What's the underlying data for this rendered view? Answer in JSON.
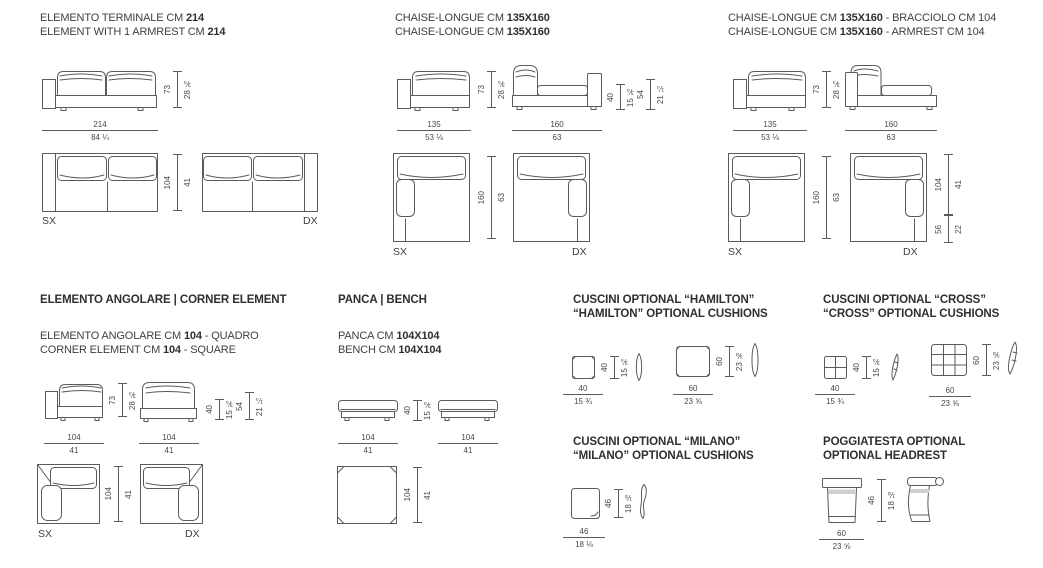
{
  "colors": {
    "line": "#5a5b5f",
    "text": "#3f4044",
    "heading": "#2e2f33",
    "background": "#ffffff"
  },
  "labels": {
    "sx": "SX",
    "dx": "DX"
  },
  "terminal": {
    "title1": {
      "pre": "ELEMENTO TERMINALE CM ",
      "bold": "214",
      "post": ""
    },
    "title2": {
      "pre": "ELEMENT WITH 1 ARMREST CM ",
      "bold": "214",
      "post": ""
    },
    "height": {
      "cm": "73",
      "in": "28 ¾"
    },
    "width": {
      "cm": "214",
      "in": "84 ¼"
    },
    "depth": {
      "cm": "104",
      "in": "41"
    }
  },
  "chaise": {
    "title1": {
      "pre": "CHAISE-LONGUE CM ",
      "bold": "135X160",
      "post": ""
    },
    "title2": {
      "pre": "CHAISE-LONGUE CM ",
      "bold": "135X160",
      "post": ""
    },
    "w135": {
      "cm": "135",
      "in": "53 ⅛"
    },
    "w160": {
      "cm": "160",
      "in": "63"
    },
    "height": {
      "cm": "73",
      "in": "28 ¾"
    },
    "seat_h": {
      "cm": "40",
      "in": "15 ¾"
    },
    "arm_h": {
      "cm": "54",
      "in": "21 ¼"
    },
    "depth": {
      "cm": "160",
      "in": "63"
    }
  },
  "chaiseArm": {
    "title1": {
      "pre": "CHAISE-LONGUE CM ",
      "bold": "135X160",
      "post": " - BRACCIOLO CM 104"
    },
    "title2": {
      "pre": "CHAISE-LONGUE CM ",
      "bold": "135X160",
      "post": " - ARMREST CM 104"
    },
    "w135": {
      "cm": "135",
      "in": "53 ⅛"
    },
    "w160": {
      "cm": "160",
      "in": "63"
    },
    "height": {
      "cm": "73",
      "in": "28 ¾"
    },
    "depth": {
      "cm": "160",
      "in": "63"
    },
    "chaise_d": {
      "cm": "104",
      "in": "41"
    },
    "arm_d": {
      "cm": "56",
      "in": "22"
    }
  },
  "corner": {
    "heading": "ELEMENTO ANGOLARE | CORNER ELEMENT",
    "sub1": {
      "pre": "ELEMENTO ANGOLARE CM ",
      "bold": "104",
      "post": " - QUADRO"
    },
    "sub2": {
      "pre": "CORNER ELEMENT CM ",
      "bold": "104",
      "post": " - SQUARE"
    },
    "height": {
      "cm": "73",
      "in": "28 ¾"
    },
    "seat_h": {
      "cm": "40",
      "in": "15 ¾"
    },
    "arm_h": {
      "cm": "54",
      "in": "21 ¼"
    },
    "width": {
      "cm": "104",
      "in": "41"
    },
    "depth": {
      "cm": "104",
      "in": "41"
    }
  },
  "bench": {
    "heading": "PANCA | BENCH",
    "sub1": {
      "pre": "PANCA CM ",
      "bold": "104X104",
      "post": ""
    },
    "sub2": {
      "pre": "BENCH CM ",
      "bold": "104X104",
      "post": ""
    },
    "height": {
      "cm": "40",
      "in": "15 ¾"
    },
    "width": {
      "cm": "104",
      "in": "41"
    },
    "depth": {
      "cm": "104",
      "in": "41"
    }
  },
  "hamilton": {
    "heading1": "CUSCINI OPTIONAL “HAMILTON”",
    "heading2": "“HAMILTON” OPTIONAL CUSHIONS",
    "small": {
      "cm": "40",
      "in": "15 ¾"
    },
    "large": {
      "cm": "60",
      "in": "23 ⅝"
    }
  },
  "cross": {
    "heading1": "CUSCINI OPTIONAL “CROSS”",
    "heading2": "“CROSS” OPTIONAL CUSHIONS",
    "small": {
      "cm": "40",
      "in": "15 ¾"
    },
    "large": {
      "cm": "60",
      "in": "23 ⅝"
    }
  },
  "milano": {
    "heading1": "CUSCINI OPTIONAL “MILANO”",
    "heading2": "“MILANO” OPTIONAL CUSHIONS",
    "size": {
      "cm": "46",
      "in": "18 ⅛"
    }
  },
  "headrest": {
    "heading1": "POGGIATESTA OPTIONAL",
    "heading2": "OPTIONAL HEADREST",
    "height": {
      "cm": "46",
      "in": "18 ⅛"
    },
    "width": {
      "cm": "60",
      "in": "23 ⅝"
    }
  }
}
